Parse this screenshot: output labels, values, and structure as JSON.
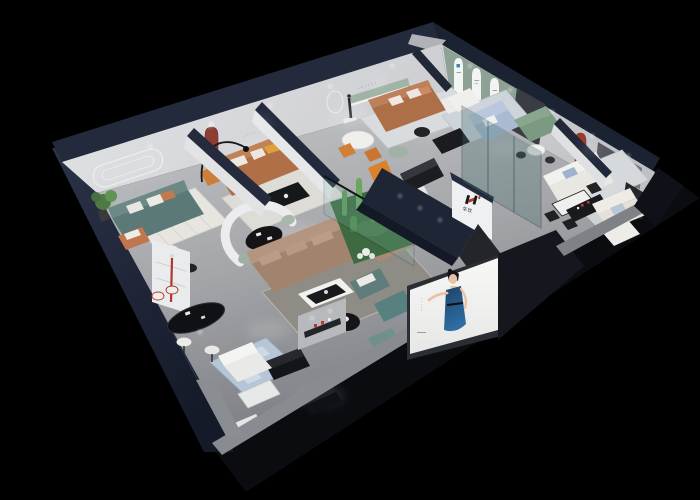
{
  "meta": {
    "title": "3D cutaway showroom render",
    "style": "elevated three-quarter isometric night scene",
    "canvas": "700x500",
    "background": "#000000"
  },
  "brand": {
    "characters": "华饮",
    "mark": "H",
    "ink": "#1c1c1e",
    "accent": "#b3352b"
  },
  "signage": {
    "hall_wall_logo": {
      "mark": "H",
      "characters": "华饮"
    },
    "display_shelf_logo": {
      "characters": "华饮",
      "colors": [
        "#b3352b",
        "#ffffff"
      ]
    },
    "gallery_arches": {
      "count": 3,
      "first_arch_mark_color": "#3b7fad"
    },
    "wall_lettering_marks": "······",
    "lounge_wall_marks": "·····"
  },
  "poster": {
    "subject": "woman in blue evening dress",
    "panel_color": "#f4f4f2",
    "dress_color": "#27557f",
    "vertical_text_marks": "·····"
  },
  "palette": {
    "wall_cap_navy": "#232b3d",
    "interior_wall": "#d9dadc",
    "floor": "#a9abaf",
    "sage_green_wall": "#91a595",
    "terracotta_niche": "#8c3e33",
    "red_arch": "#9c3a28",
    "caramel_leather": "#b06f46",
    "teal_fabric": "#5b7a77",
    "taupe_sectional": "#a2846e",
    "pale_blue_sofa": "#a9bad1",
    "cactus_green": "#5d9955",
    "rug_blue": "#b7c6d6",
    "gloss_black": "#141518",
    "cream": "#e9e7e2",
    "accent_orange": "#d9822b"
  },
  "rooms": [
    {
      "id": "teal-lounge",
      "position": "far left",
      "items": [
        "teal three-seat sofa",
        "striped rug",
        "round white coffee table",
        "potted plant",
        "grooved feature wall",
        "tan armchair"
      ]
    },
    {
      "id": "caramel-lounge",
      "position": "back left",
      "items": [
        "caramel leather sofa",
        "terracotta arched niche",
        "arc floor lamp",
        "black coffee table",
        "orange accent chair"
      ]
    },
    {
      "id": "display-lounge",
      "position": "back center",
      "items": [
        "caramel sofa",
        "white armchair",
        "recessed green shelf",
        "round mirror",
        "statue on pedestal",
        "orange dining chairs",
        "sage ottoman"
      ]
    },
    {
      "id": "arch-gallery",
      "position": "top",
      "items": [
        "sage green wall",
        "three arched posters",
        "pale blue sofa",
        "white armchair",
        "black console",
        "glass partition"
      ]
    },
    {
      "id": "meeting-nook",
      "position": "top right",
      "items": [
        "green loveseat",
        "round white table",
        "black chairs"
      ]
    },
    {
      "id": "white-suite",
      "position": "right",
      "items": [
        "white fabric sofa",
        "red arched niche",
        "dining table with black chairs",
        "grey wall panels"
      ]
    },
    {
      "id": "corner-suite",
      "position": "far right",
      "items": [
        "cream sectional",
        "dark TV panel",
        "media console with brand items",
        "white lounger"
      ]
    },
    {
      "id": "central-hall",
      "position": "center",
      "items": [
        "taupe L-sectional",
        "white coffee table",
        "curved white partition",
        "black oval table",
        "sage barrel chairs",
        "cactus terrarium behind glass",
        "two teal armchairs",
        "round black side table",
        "teal ottoman",
        "gloss black media benches",
        "brand display shelf"
      ]
    },
    {
      "id": "bar-lounge",
      "position": "front left",
      "items": [
        "black oval bar table",
        "two stools",
        "white shelving with red floor lamp",
        "patterned blue rug",
        "white sofa",
        "gloss black cabinets",
        "white cabinet"
      ]
    },
    {
      "id": "storefront",
      "position": "front",
      "items": [
        "model poster",
        "glass frontage",
        "cut wall slabs"
      ]
    }
  ],
  "structure": {
    "exterior_shell": "dark navy cutaway walls",
    "lighting": "recessed spotlights with floor light pools",
    "view": "isometric perspective from above"
  }
}
